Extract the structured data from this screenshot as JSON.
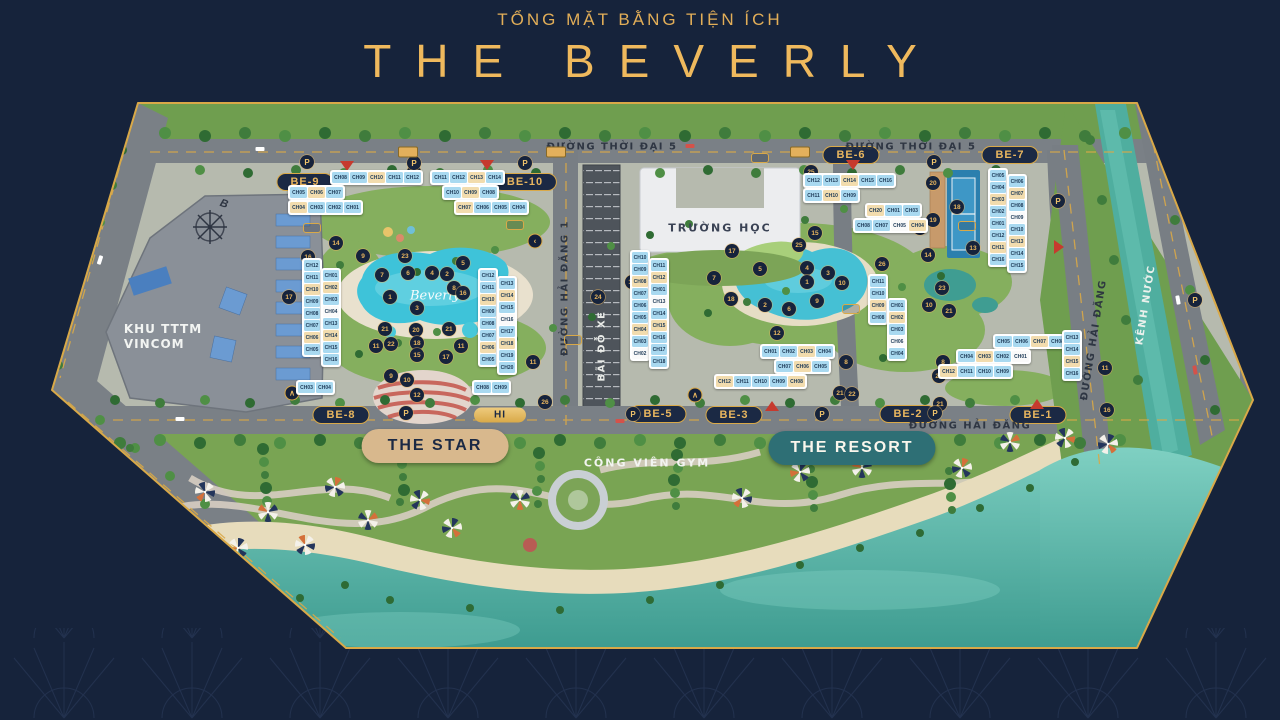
{
  "header": {
    "subtitle": "TỔNG MẶT BẰNG TIỆN ÍCH",
    "title": "THE BEVERLY"
  },
  "colors": {
    "background": "#16233B",
    "gold": "#EFB95D",
    "map_border": "#D9A948",
    "sea": "#2E9488",
    "pool": "#3EC3D9",
    "canal": "#4FAE9F",
    "star_pill": "#D8B88D",
    "resort_pill": "#2E6F75",
    "zone_pill_bg": "#1B2944"
  },
  "map": {
    "labels": {
      "vincom1": "KHU TTTM",
      "vincom2": "VINCOM",
      "school": "TRƯỜNG HỌC",
      "gym": "CÔNG VIÊN GYM",
      "pool_script": "Beverly",
      "compass": "B",
      "parking_letter": "P"
    },
    "zone_pills": [
      {
        "label": "BE-9",
        "x": 305,
        "y": 182
      },
      {
        "label": "BE-10",
        "x": 525,
        "y": 182
      },
      {
        "label": "BE-6",
        "x": 851,
        "y": 155
      },
      {
        "label": "BE-7",
        "x": 1010,
        "y": 155
      },
      {
        "label": "BE-8",
        "x": 341,
        "y": 415
      },
      {
        "label": "BE-5",
        "x": 658,
        "y": 414
      },
      {
        "label": "BE-3",
        "x": 734,
        "y": 415
      },
      {
        "label": "BE-2",
        "x": 908,
        "y": 414
      },
      {
        "label": "BE-1",
        "x": 1038,
        "y": 415
      }
    ],
    "feature_pills": [
      {
        "label": "THE STAR",
        "x": 435,
        "y": 446,
        "style": "star"
      },
      {
        "label": "THE RESORT",
        "x": 852,
        "y": 448,
        "style": "resort"
      },
      {
        "label": "HI",
        "x": 500,
        "y": 415,
        "style": "gold"
      }
    ],
    "street_labels": [
      {
        "label": "ĐƯỜNG THỜI ĐẠI 5",
        "x": 612,
        "y": 147,
        "rotate": 0,
        "light": false
      },
      {
        "label": "ĐƯỜNG THỜI ĐẠI 5",
        "x": 911,
        "y": 147,
        "rotate": 0,
        "light": false
      },
      {
        "label": "ĐƯỜNG HẢI ĐĂNG 1",
        "x": 565,
        "y": 288,
        "rotate": -90,
        "light": false
      },
      {
        "label": "BÃI ĐỖ XE",
        "x": 602,
        "y": 346,
        "rotate": -90,
        "light": true
      },
      {
        "label": "ĐƯỜNG HẢI ĐĂNG",
        "x": 970,
        "y": 426,
        "rotate": 0,
        "light": false
      },
      {
        "label": "ĐƯỜNG HẢI ĐĂNG",
        "x": 1094,
        "y": 340,
        "rotate": -81,
        "light": false
      },
      {
        "label": "KÊNH NƯỚC",
        "x": 1146,
        "y": 305,
        "rotate": -81,
        "light": true
      }
    ],
    "markers": [
      {
        "n": "25",
        "x": 414,
        "y": 172
      },
      {
        "n": "25",
        "x": 811,
        "y": 172
      },
      {
        "n": "16",
        "x": 308,
        "y": 257
      },
      {
        "n": "17",
        "x": 289,
        "y": 297
      },
      {
        "n": "14",
        "x": 336,
        "y": 243
      },
      {
        "n": "9",
        "x": 363,
        "y": 256
      },
      {
        "n": "23",
        "x": 405,
        "y": 256
      },
      {
        "n": "5",
        "x": 463,
        "y": 263
      },
      {
        "n": "7",
        "x": 382,
        "y": 275
      },
      {
        "n": "6",
        "x": 408,
        "y": 273
      },
      {
        "n": "4",
        "x": 432,
        "y": 273
      },
      {
        "n": "2",
        "x": 447,
        "y": 274
      },
      {
        "n": "1",
        "x": 390,
        "y": 297
      },
      {
        "n": "8",
        "x": 454,
        "y": 288
      },
      {
        "n": "16",
        "x": 463,
        "y": 293
      },
      {
        "n": "3",
        "x": 417,
        "y": 308
      },
      {
        "n": "21",
        "x": 385,
        "y": 329
      },
      {
        "n": "20",
        "x": 416,
        "y": 330
      },
      {
        "n": "21",
        "x": 449,
        "y": 329
      },
      {
        "n": "11",
        "x": 376,
        "y": 346
      },
      {
        "n": "22",
        "x": 391,
        "y": 344
      },
      {
        "n": "18",
        "x": 417,
        "y": 343
      },
      {
        "n": "11",
        "x": 461,
        "y": 346
      },
      {
        "n": "15",
        "x": 417,
        "y": 355
      },
      {
        "n": "17",
        "x": 446,
        "y": 357
      },
      {
        "n": "9",
        "x": 391,
        "y": 376
      },
      {
        "n": "10",
        "x": 407,
        "y": 380
      },
      {
        "n": "12",
        "x": 417,
        "y": 395
      },
      {
        "n": "24",
        "x": 598,
        "y": 297
      },
      {
        "n": "17",
        "x": 632,
        "y": 282
      },
      {
        "n": "26",
        "x": 545,
        "y": 402
      },
      {
        "n": "11",
        "x": 533,
        "y": 362
      },
      {
        "n": "20",
        "x": 933,
        "y": 183
      },
      {
        "n": "18",
        "x": 957,
        "y": 207
      },
      {
        "n": "19",
        "x": 933,
        "y": 220
      },
      {
        "n": "24",
        "x": 920,
        "y": 228
      },
      {
        "n": "13",
        "x": 973,
        "y": 248
      },
      {
        "n": "15",
        "x": 815,
        "y": 233
      },
      {
        "n": "25",
        "x": 799,
        "y": 245
      },
      {
        "n": "17",
        "x": 732,
        "y": 251
      },
      {
        "n": "5",
        "x": 760,
        "y": 269
      },
      {
        "n": "14",
        "x": 928,
        "y": 255
      },
      {
        "n": "7",
        "x": 714,
        "y": 278
      },
      {
        "n": "4",
        "x": 807,
        "y": 268
      },
      {
        "n": "3",
        "x": 828,
        "y": 273
      },
      {
        "n": "1",
        "x": 807,
        "y": 282
      },
      {
        "n": "10",
        "x": 842,
        "y": 283
      },
      {
        "n": "23",
        "x": 942,
        "y": 288
      },
      {
        "n": "18",
        "x": 731,
        "y": 299
      },
      {
        "n": "2",
        "x": 765,
        "y": 305
      },
      {
        "n": "9",
        "x": 817,
        "y": 301
      },
      {
        "n": "6",
        "x": 789,
        "y": 309
      },
      {
        "n": "26",
        "x": 882,
        "y": 264
      },
      {
        "n": "10",
        "x": 929,
        "y": 305
      },
      {
        "n": "21",
        "x": 949,
        "y": 311
      },
      {
        "n": "12",
        "x": 777,
        "y": 333
      },
      {
        "n": "8",
        "x": 846,
        "y": 362
      },
      {
        "n": "8",
        "x": 943,
        "y": 362
      },
      {
        "n": "22",
        "x": 939,
        "y": 376
      },
      {
        "n": "21",
        "x": 840,
        "y": 393
      },
      {
        "n": "22",
        "x": 852,
        "y": 394
      },
      {
        "n": "21",
        "x": 940,
        "y": 404
      },
      {
        "n": "11",
        "x": 1105,
        "y": 368
      },
      {
        "n": "16",
        "x": 1107,
        "y": 410
      }
    ],
    "parking_markers": [
      {
        "x": 307,
        "y": 162
      },
      {
        "x": 414,
        "y": 163
      },
      {
        "x": 525,
        "y": 163
      },
      {
        "x": 934,
        "y": 162
      },
      {
        "x": 1058,
        "y": 201
      },
      {
        "x": 406,
        "y": 413
      },
      {
        "x": 633,
        "y": 414
      },
      {
        "x": 822,
        "y": 414
      },
      {
        "x": 935,
        "y": 413
      },
      {
        "x": 1195,
        "y": 300
      }
    ],
    "gate_markers": [
      {
        "x": 347,
        "y": 166,
        "dir": "down"
      },
      {
        "x": 487,
        "y": 165,
        "dir": "down"
      },
      {
        "x": 853,
        "y": 165,
        "dir": "down"
      },
      {
        "x": 772,
        "y": 406,
        "dir": "up"
      },
      {
        "x": 1037,
        "y": 404,
        "dir": "up"
      },
      {
        "x": 1059,
        "y": 247,
        "dir": "right"
      }
    ],
    "sign_markers": [
      {
        "x": 312,
        "y": 228
      },
      {
        "x": 515,
        "y": 225
      },
      {
        "x": 851,
        "y": 309
      },
      {
        "x": 573,
        "y": 340
      },
      {
        "x": 967,
        "y": 226
      },
      {
        "x": 760,
        "y": 158
      }
    ],
    "bus_stops": [
      {
        "x": 408,
        "y": 152
      },
      {
        "x": 556,
        "y": 152
      },
      {
        "x": 800,
        "y": 152
      }
    ],
    "arrow_markers": [
      {
        "x": 292,
        "y": 393,
        "ch": "∧"
      },
      {
        "x": 535,
        "y": 241,
        "ch": "‹"
      },
      {
        "x": 695,
        "y": 395,
        "ch": "∧"
      }
    ],
    "clusters": [
      {
        "id": "be9",
        "x": 330,
        "y": 170,
        "dir": "h",
        "rows": [
          {
            "dx": 0,
            "dy": 0,
            "cells": [
              "CH08",
              "CH09",
              "CH10",
              "CH11",
              "CH12"
            ]
          },
          {
            "dx": -42,
            "dy": 0,
            "cells": [
              "CH05",
              "CH06",
              "CH07"
            ]
          },
          {
            "dx": -42,
            "dy": 0,
            "cells": [
              "CH04",
              "CH03",
              "CH02",
              "CH01"
            ]
          }
        ]
      },
      {
        "id": "be10",
        "x": 430,
        "y": 170,
        "dir": "h",
        "rows": [
          {
            "dx": 0,
            "dy": 0,
            "cells": [
              "CH11",
              "CH12",
              "CH13",
              "CH14"
            ]
          },
          {
            "dx": 12,
            "dy": 0,
            "cells": [
              "CH10",
              "CH09",
              "CH08"
            ]
          },
          {
            "dx": 24,
            "dy": 0,
            "cells": [
              "CH07",
              "CH06",
              "CH05",
              "CH04"
            ]
          }
        ]
      },
      {
        "id": "be8-west",
        "x": 302,
        "y": 258,
        "dir": "v",
        "rows": [
          {
            "dx": 0,
            "dy": 0,
            "cells": [
              "CH12",
              "CH11",
              "CH10",
              "CH09",
              "CH08",
              "CH07",
              "CH06",
              "CH05"
            ]
          },
          {
            "dx": 0,
            "dy": 10,
            "cells": [
              "CH01",
              "CH02",
              "CH03",
              "CH04",
              "CH13",
              "CH14",
              "CH15",
              "CH16"
            ]
          }
        ]
      },
      {
        "id": "be8-row",
        "x": 296,
        "y": 380,
        "dir": "h",
        "rows": [
          {
            "dx": 0,
            "dy": 0,
            "cells": [
              "CH03",
              "CH04"
            ]
          }
        ]
      },
      {
        "id": "be10-south",
        "x": 478,
        "y": 268,
        "dir": "v",
        "rows": [
          {
            "dx": 0,
            "dy": 0,
            "cells": [
              "CH12",
              "CH11",
              "CH10",
              "CH09",
              "CH08",
              "CH07",
              "CH06",
              "CH05"
            ]
          },
          {
            "dx": 0,
            "dy": 8,
            "cells": [
              "CH13",
              "CH14",
              "CH15",
              "CH16",
              "CH17",
              "CH18",
              "CH19",
              "CH20"
            ]
          }
        ]
      },
      {
        "id": "be10-row",
        "x": 472,
        "y": 380,
        "dir": "h",
        "rows": [
          {
            "dx": 0,
            "dy": 0,
            "cells": [
              "CH08",
              "CH09"
            ]
          }
        ]
      },
      {
        "id": "be6",
        "x": 803,
        "y": 173,
        "dir": "h",
        "rows": [
          {
            "dx": 0,
            "dy": 0,
            "cells": [
              "CH12",
              "CH13",
              "CH14",
              "CH15",
              "CH16"
            ]
          },
          {
            "dx": 0,
            "dy": 0,
            "cells": [
              "CH11",
              "CH10",
              "CH09"
            ]
          },
          {
            "dx": 62,
            "dy": 0,
            "cells": [
              "CH20",
              "CH01",
              "CH03"
            ]
          },
          {
            "dx": 50,
            "dy": 0,
            "cells": [
              "CH08",
              "CH07",
              "CH05",
              "CH04"
            ]
          }
        ]
      },
      {
        "id": "be7",
        "x": 988,
        "y": 168,
        "dir": "v",
        "rows": [
          {
            "dx": 0,
            "dy": 0,
            "cells": [
              "CH05",
              "CH04",
              "CH03",
              "CH02",
              "CH01",
              "CH12",
              "CH11",
              "CH16"
            ]
          },
          {
            "dx": 0,
            "dy": 6,
            "cells": [
              "CH06",
              "CH07",
              "CH08",
              "CH09",
              "CH10",
              "CH13",
              "CH14",
              "CH15"
            ]
          }
        ]
      },
      {
        "id": "be5",
        "x": 630,
        "y": 250,
        "dir": "v",
        "rows": [
          {
            "dx": 0,
            "dy": 0,
            "cells": [
              "CH10",
              "CH09",
              "CH08",
              "CH07",
              "CH06",
              "CH05",
              "CH04",
              "CH03",
              "CH02"
            ]
          },
          {
            "dx": 0,
            "dy": 8,
            "cells": [
              "CH11",
              "CH12",
              "CH01",
              "CH13",
              "CH14",
              "CH15",
              "CH16",
              "CH17",
              "CH18"
            ]
          }
        ]
      },
      {
        "id": "be3",
        "x": 714,
        "y": 344,
        "dir": "h",
        "rows": [
          {
            "dx": 46,
            "dy": 0,
            "cells": [
              "CH01",
              "CH02",
              "CH03",
              "CH04"
            ]
          },
          {
            "dx": 60,
            "dy": 0,
            "cells": [
              "CH07",
              "CH06",
              "CH05"
            ]
          },
          {
            "dx": 0,
            "dy": 0,
            "cells": [
              "CH12",
              "CH11",
              "CH10",
              "CH09",
              "CH08"
            ]
          }
        ]
      },
      {
        "id": "be2",
        "x": 868,
        "y": 274,
        "dir": "v",
        "rows": [
          {
            "dx": 0,
            "dy": 0,
            "cells": [
              "CH11",
              "CH10",
              "CH09",
              "CH08"
            ]
          },
          {
            "dx": 0,
            "dy": 24,
            "cells": [
              "CH01",
              "CH02",
              "CH03",
              "CH06",
              "CH04"
            ]
          }
        ]
      },
      {
        "id": "be1",
        "x": 938,
        "y": 334,
        "dir": "h",
        "rows": [
          {
            "dx": 55,
            "dy": 0,
            "cells": [
              "CH05",
              "CH06",
              "CH07",
              "CH08"
            ]
          },
          {
            "dx": 18,
            "dy": 0,
            "cells": [
              "CH04",
              "CH03",
              "CH02",
              "CH01"
            ]
          },
          {
            "dx": 0,
            "dy": 0,
            "cells": [
              "CH12",
              "CH11",
              "CH10",
              "CH09"
            ]
          }
        ]
      },
      {
        "id": "be1-east",
        "x": 1062,
        "y": 330,
        "dir": "v",
        "rows": [
          {
            "dx": 0,
            "dy": 0,
            "cells": [
              "CH13",
              "CH14",
              "CH15",
              "CH16"
            ]
          }
        ]
      }
    ]
  }
}
